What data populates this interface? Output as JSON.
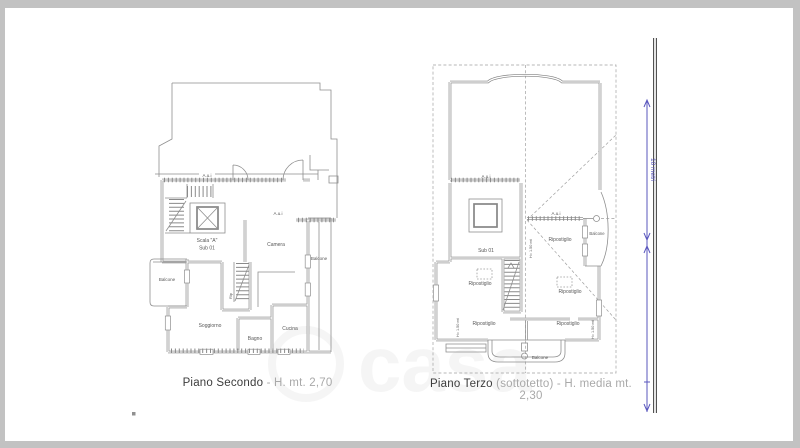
{
  "scale_bar": {
    "label": "10 metri",
    "color": "#5a57be"
  },
  "watermark": {
    "symbol": "©",
    "text": "casa"
  },
  "plans": {
    "left": {
      "caption_title": "Piano Secondo",
      "caption_detail": " - H. mt. 2,70",
      "labels": {
        "aui_top": "A.u.i",
        "aui_mid": "A.u.i",
        "scala": "Scala \"A\"",
        "sub": "Sub 01",
        "camera": "Camera",
        "balcone_right": "Balcone",
        "balcone_left": "Balcone",
        "rip": "Rip",
        "soggiorno": "Soggiorno",
        "bagno": "Bagno",
        "cucina": "Cucina"
      }
    },
    "right": {
      "caption_title": "Piano Terzo ",
      "caption_detail": "(sottotetto) - H. media mt. 2,30",
      "labels": {
        "aui_top": "A.u.i",
        "aui_mid": "A.u.i",
        "sub": "Sub 01",
        "rip_center": "Ripostiglio",
        "balcone_right": "Balcone",
        "h_center": "H= 1.50 mt",
        "rip_ul": "Ripostiglio",
        "rip_ur": "Ripostiglio",
        "rip_ml": "Ripostiglio",
        "rip_mr": "Ripostiglio",
        "h_left": "H= 1.50 mt",
        "h_right": "H= 1.50 mt",
        "balcone_bottom": "Balcone"
      }
    }
  }
}
